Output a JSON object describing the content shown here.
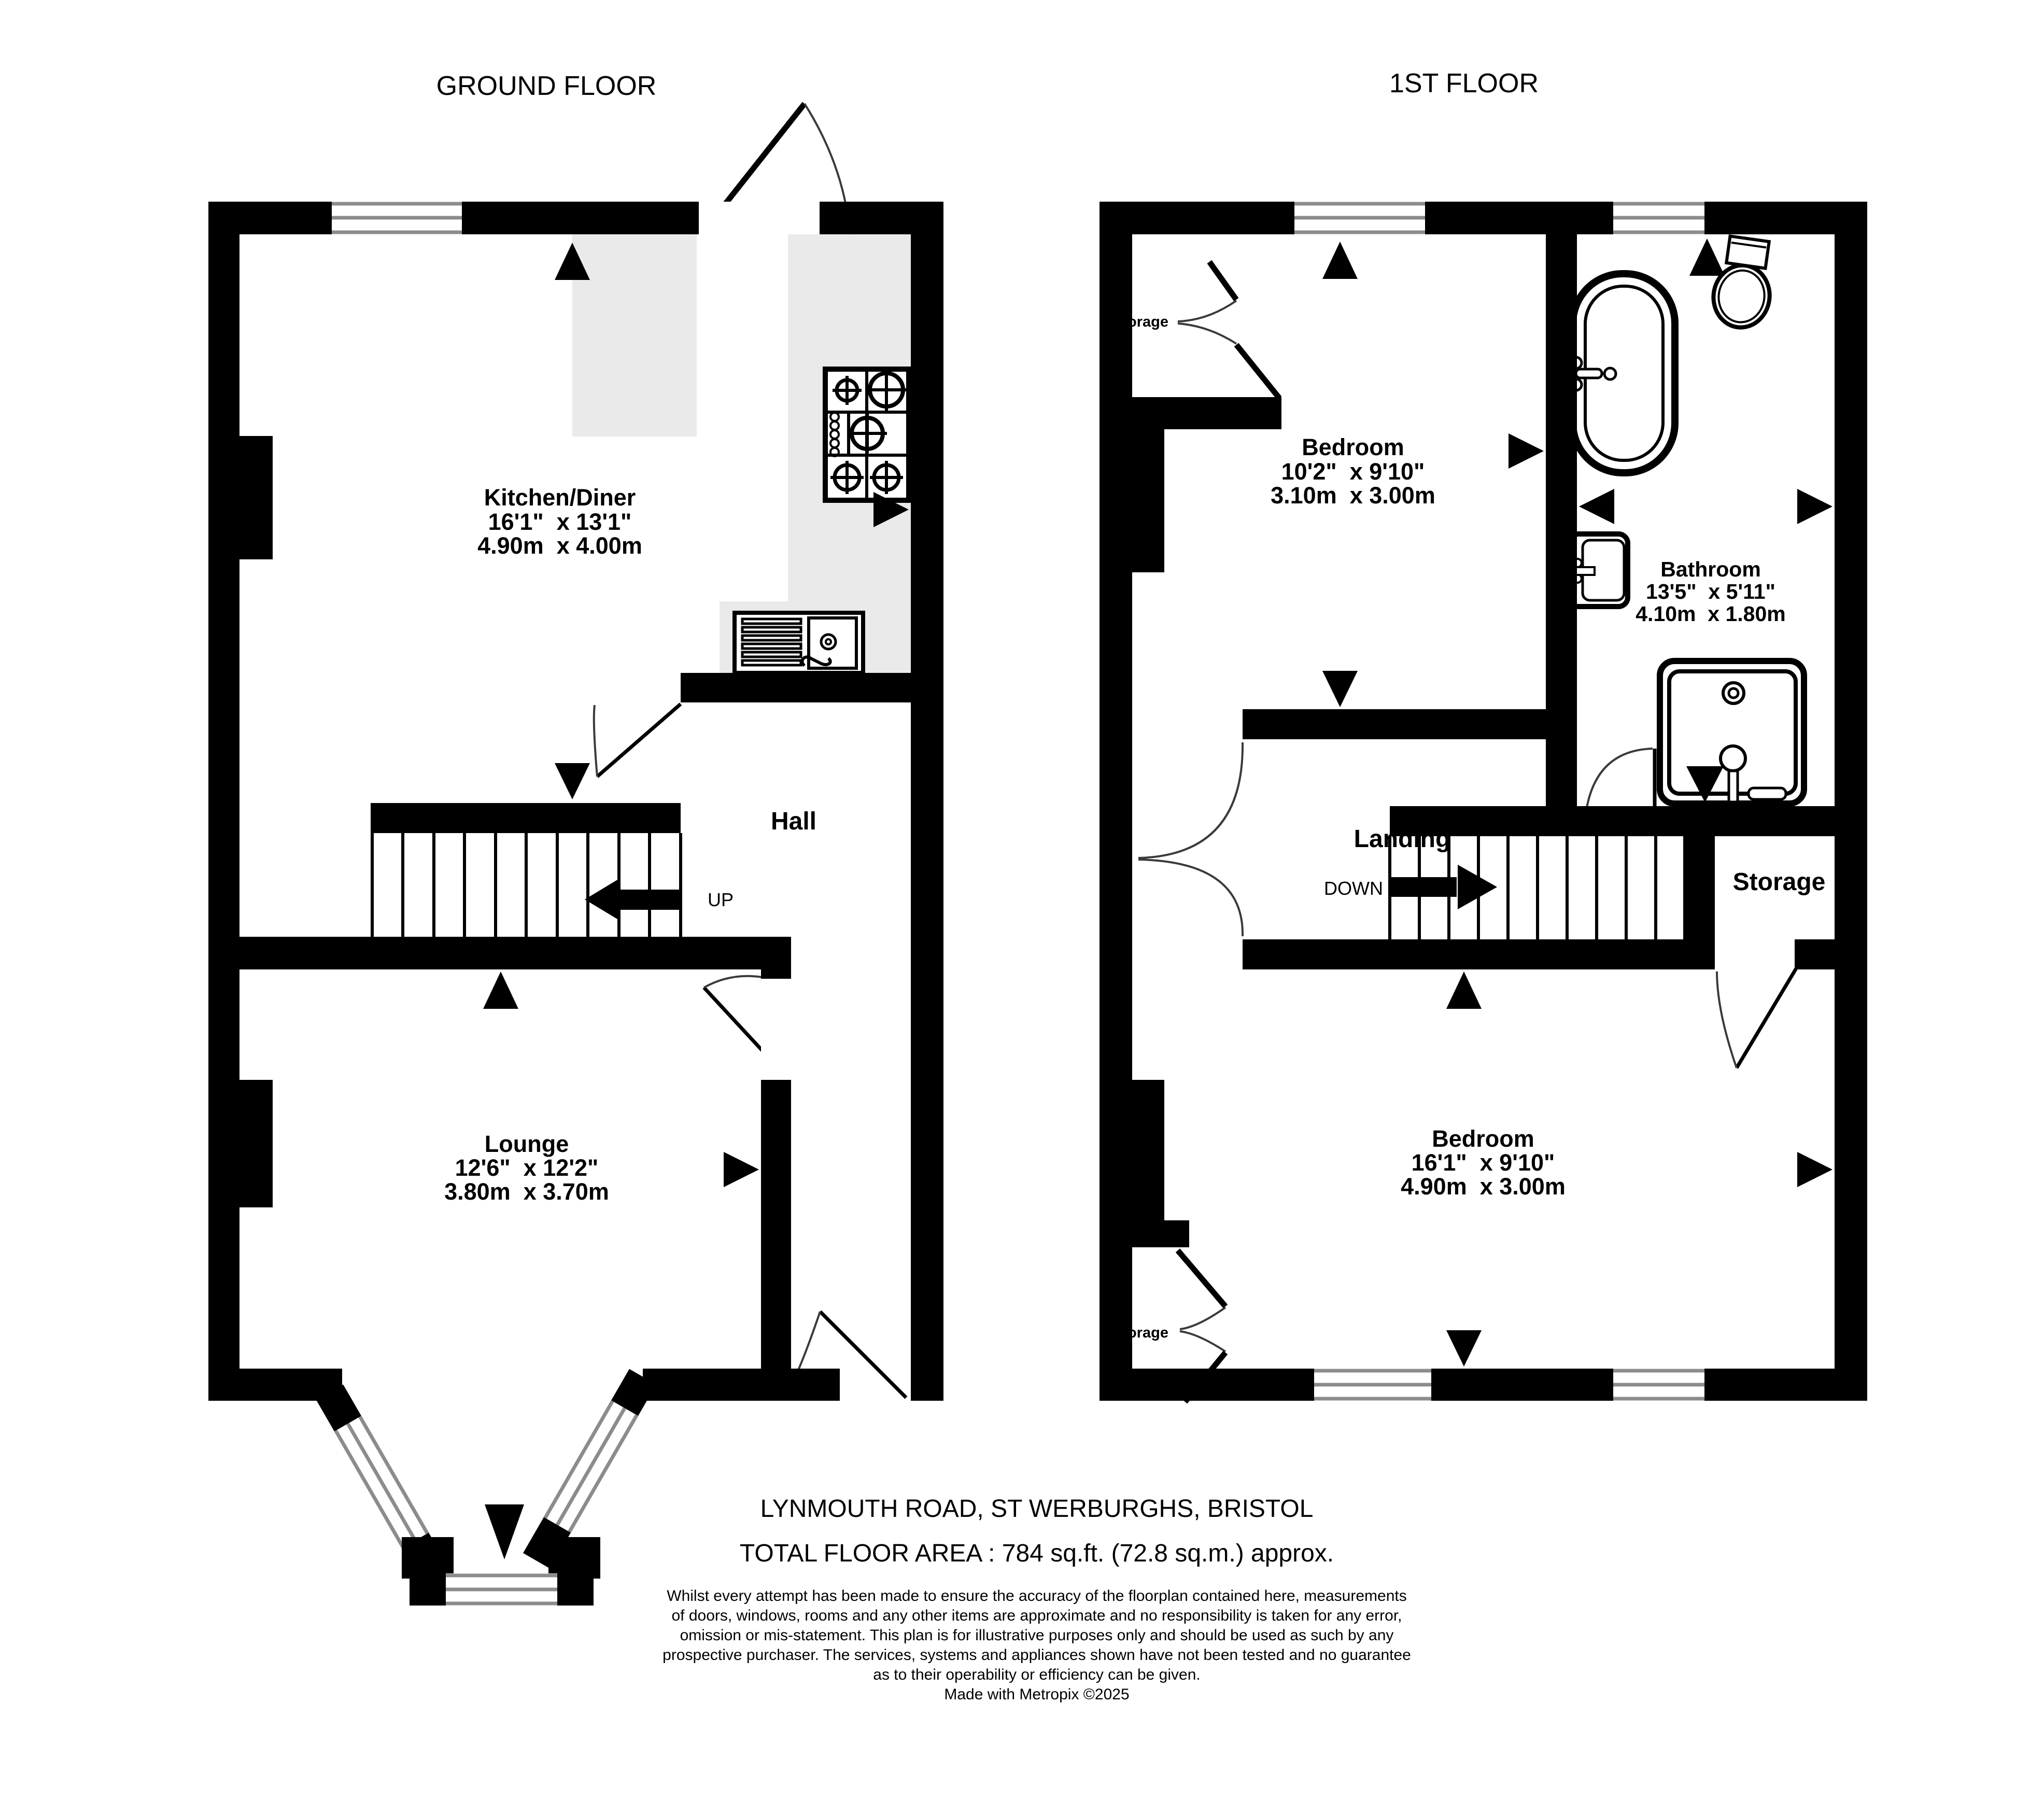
{
  "ground_floor": {
    "title": "GROUND FLOOR",
    "kitchen": {
      "name": "Kitchen/Diner",
      "imperial": "16'1\"  x 13'1\"",
      "metric": "4.90m  x 4.00m"
    },
    "lounge": {
      "name": "Lounge",
      "imperial": "12'6\"  x 12'2\"",
      "metric": "3.80m  x 3.70m"
    },
    "hall": {
      "name": "Hall"
    },
    "stairs_label": "UP"
  },
  "first_floor": {
    "title": "1ST FLOOR",
    "bedroom_front": {
      "name": "Bedroom",
      "imperial": "10'2\"  x 9'10\"",
      "metric": "3.10m  x 3.00m"
    },
    "bathroom": {
      "name": "Bathroom",
      "imperial": "13'5\"  x 5'11\"",
      "metric": "4.10m  x 1.80m"
    },
    "landing": {
      "name": "Landing"
    },
    "storage_room": {
      "name": "Storage"
    },
    "storage_closet_top": {
      "name": "Storage"
    },
    "storage_closet_bottom": {
      "name": "Storage"
    },
    "bedroom_back": {
      "name": "Bedroom",
      "imperial": "16'1\"  x 9'10\"",
      "metric": "4.90m  x 3.00m"
    },
    "stairs_label": "DOWN"
  },
  "footer": {
    "address": "LYNMOUTH ROAD, ST WERBURGHS, BRISTOL",
    "total_area": "TOTAL FLOOR AREA : 784 sq.ft. (72.8 sq.m.) approx.",
    "disclaimer_lines": [
      "Whilst every attempt has been made to ensure the accuracy of the floorplan contained here, measurements",
      "of doors, windows, rooms and any other items are approximate and no responsibility is taken for any error,",
      "omission or mis-statement. This plan is for illustrative purposes only and should be used as such by any",
      "prospective purchaser. The services, systems and appliances shown have not been tested and no guarantee",
      "as to their operability or efficiency can be given."
    ],
    "credit": "Made with Metropix ©2025"
  },
  "colors": {
    "wall": "#000000",
    "counter": "#eaeaea",
    "window_line": "#8c8c8c"
  }
}
